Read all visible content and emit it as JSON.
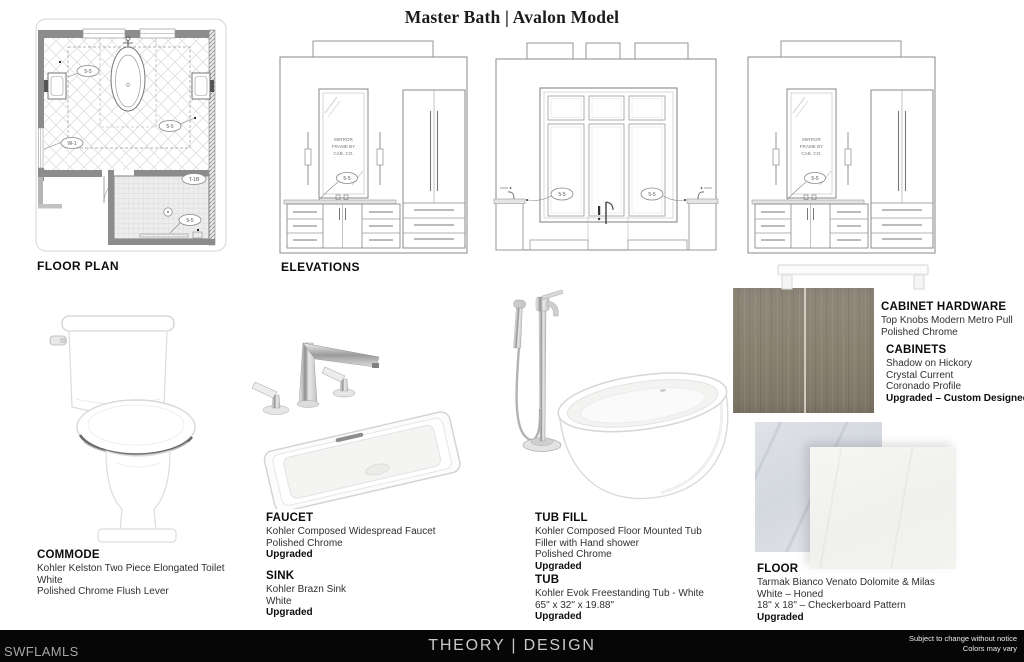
{
  "title": "Master Bath | Avalon Model",
  "drawings": {
    "floor_plan_label": "FLOOR PLAN",
    "elevations_label": "ELEVATIONS",
    "tag_55": "5-5",
    "tag_w1": "W-1",
    "tag_t1b": "T-1B",
    "mirror_note_1": "MIRROR",
    "mirror_note_2": "FRAME BY",
    "mirror_note_3": "CAB. CO."
  },
  "products": {
    "commode": {
      "heading": "COMMODE",
      "line1": "Kohler Kelston Two Piece Elongated Toilet",
      "line2": "White",
      "line3": "Polished Chrome Flush Lever"
    },
    "faucet": {
      "heading": "FAUCET",
      "line1": "Kohler Composed Widespread Faucet",
      "line2": "Polished Chrome",
      "line3": "Upgraded"
    },
    "sink": {
      "heading": "SINK",
      "line1": "Kohler Brazn Sink",
      "line2": "White",
      "line3": "Upgraded"
    },
    "tub_fill": {
      "heading": "TUB FILL",
      "line1": "Kohler Composed Floor Mounted Tub",
      "line2": "Filler with Hand shower",
      "line3": "Polished Chrome",
      "line4": "Upgraded"
    },
    "tub": {
      "heading": "TUB",
      "line1": "Kohler Evok Freestanding Tub - White",
      "line2": "65\" x 32\" x 19.88\"",
      "line3": "Upgraded"
    },
    "cabinet_hardware": {
      "heading": "CABINET HARDWARE",
      "line1": "Top Knobs Modern Metro Pull",
      "line2": "Polished Chrome"
    },
    "cabinets": {
      "heading": "CABINETS",
      "line1": "Shadow on Hickory",
      "line2": "Crystal Current",
      "line3": "Coronado Profile",
      "line4": "Upgraded – Custom Designed"
    },
    "floor": {
      "heading": "FLOOR",
      "line1": "Tarmak Bianco Venato Dolomite & Milas",
      "line2": "White – Honed",
      "line3": "18\" x 18\" – Checkerboard Pattern",
      "line4": "Upgraded"
    }
  },
  "colors": {
    "cabinet_swatch": "#8a8274",
    "tile_back": "#d7dbe0",
    "tile_front": "#f2f2ef",
    "footer_bg": "#060606"
  },
  "footer": {
    "left": "SWFLAMLS",
    "center": "THEORY | DESIGN",
    "right_line1": "Subject to change without notice",
    "right_line2": "Colors may vary"
  }
}
